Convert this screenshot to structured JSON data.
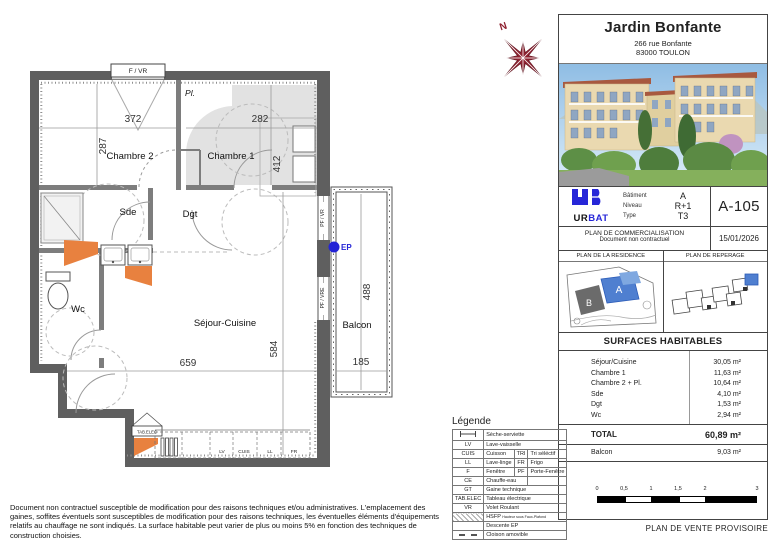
{
  "colors": {
    "wall": "#5f5f5f",
    "accent_blue": "#2323d6",
    "radiator_orange": "#e8813f",
    "compass_red": "#8e2130",
    "highlight_building": "#4f7fd0"
  },
  "plan": {
    "rooms": {
      "chambre2": "Chambre 2",
      "chambre1": "Chambre 1",
      "sde": "Sde",
      "dgt": "Dgt",
      "wc": "Wc",
      "sejour": "Séjour-Cuisine",
      "balcon": "Balcon",
      "placard": "Pl."
    },
    "dims": {
      "d372": "372",
      "d282": "282",
      "d287": "287",
      "d412": "412",
      "d488": "488",
      "d584": "584",
      "d659": "659",
      "d185": "185"
    },
    "labels": {
      "f_vr": "F / VR",
      "pf_vr": "PF / VR",
      "pf_vre": "PF / VRE",
      "ep": "EP",
      "tab_elec": "TAB.ELEC",
      "lv": "LV",
      "cuis": "CUIS",
      "ll": "LL",
      "fr": "FR"
    }
  },
  "legend": {
    "title": "Légende",
    "rows": [
      {
        "icon": "towel-radiator-icon",
        "c1": "Sèche-serviette"
      },
      {
        "c0": "LV",
        "c1": "Lave-vaisselle"
      },
      {
        "c0": "CUIS",
        "c1": "Cuisson",
        "c2": "TRI",
        "c3": "Tri séléctif"
      },
      {
        "c0": "LL",
        "c1": "Lave-linge",
        "c2": "FR",
        "c3": "Frigo"
      },
      {
        "c0": "F",
        "c1": "Fenêtre",
        "c2": "PF",
        "c3": "Porte-Fenêtre"
      },
      {
        "c0": "CE",
        "c1": "Chauffe-eau"
      },
      {
        "c0": "GT",
        "c1": "Gaine technique"
      },
      {
        "c0": "TAB.ELEC",
        "c1": "Tableau électrique"
      },
      {
        "c0": "VR",
        "c1": "Volet Roulant"
      },
      {
        "icon": "hatch-icon",
        "c1a": "HSFP",
        "c1b": "Hauteur sous Faux-Plafond"
      },
      {
        "c0": "",
        "c1": "Descente EP"
      },
      {
        "icon": "dashed-partition-icon",
        "c1": "Cloison amovible"
      }
    ]
  },
  "disclaimer": "Document non contractuel susceptible de modification pour des raisons techniques et/ou administratives. L'emplacement des gaines, soffites éventuels sont susceptibles de modification pour des raisons techniques, les éventuelles éléments d'équipements relatifs au chauffage ne sont indiqués. La surface habitable peut varier de plus ou moins 5% en fonction des techniques de construction choisies.",
  "panel": {
    "title": "Jardin Bonfante",
    "address1": "266 rue Bonfante",
    "address2": "83000 TOULON",
    "compass_n": "N",
    "logo": {
      "ur": "UR",
      "bat": "BAT"
    },
    "info": {
      "batiment_label": "Bâtiment",
      "batiment": "A",
      "niveau_label": "Niveau",
      "niveau": "R+1",
      "type_label": "Type",
      "type": "T3",
      "unit": "A-105"
    },
    "comm_line1": "PLAN DE COMMERCIALISATION",
    "comm_line2": "Document non contractuel",
    "date": "15/01/2026",
    "residence_label": "PLAN DE LA RESIDENCE",
    "reperage_label": "PLAN DE REPERAGE",
    "building_a": "A",
    "building_b": "B",
    "surfaces_title": "SURFACES HABITABLES",
    "surfaces": [
      {
        "label": "Séjour/Cuisine",
        "value": "30,05 m²"
      },
      {
        "label": "Chambre 1",
        "value": "11,63 m²"
      },
      {
        "label": "Chambre 2 + Pl.",
        "value": "10,64 m²"
      },
      {
        "label": "Sde",
        "value": "4,10 m²"
      },
      {
        "label": "Dgt",
        "value": "1,53 m²"
      },
      {
        "label": "Wc",
        "value": "2,94 m²"
      }
    ],
    "total_label": "TOTAL",
    "total_value": "60,89 m²",
    "balcon_label": "Balcon",
    "balcon_value": "9,03 m²",
    "scale": {
      "ticks": [
        "0",
        "0,5",
        "1",
        "1,5",
        "2",
        "3"
      ]
    },
    "footer": "PLAN DE VENTE PROVISOIRE"
  }
}
